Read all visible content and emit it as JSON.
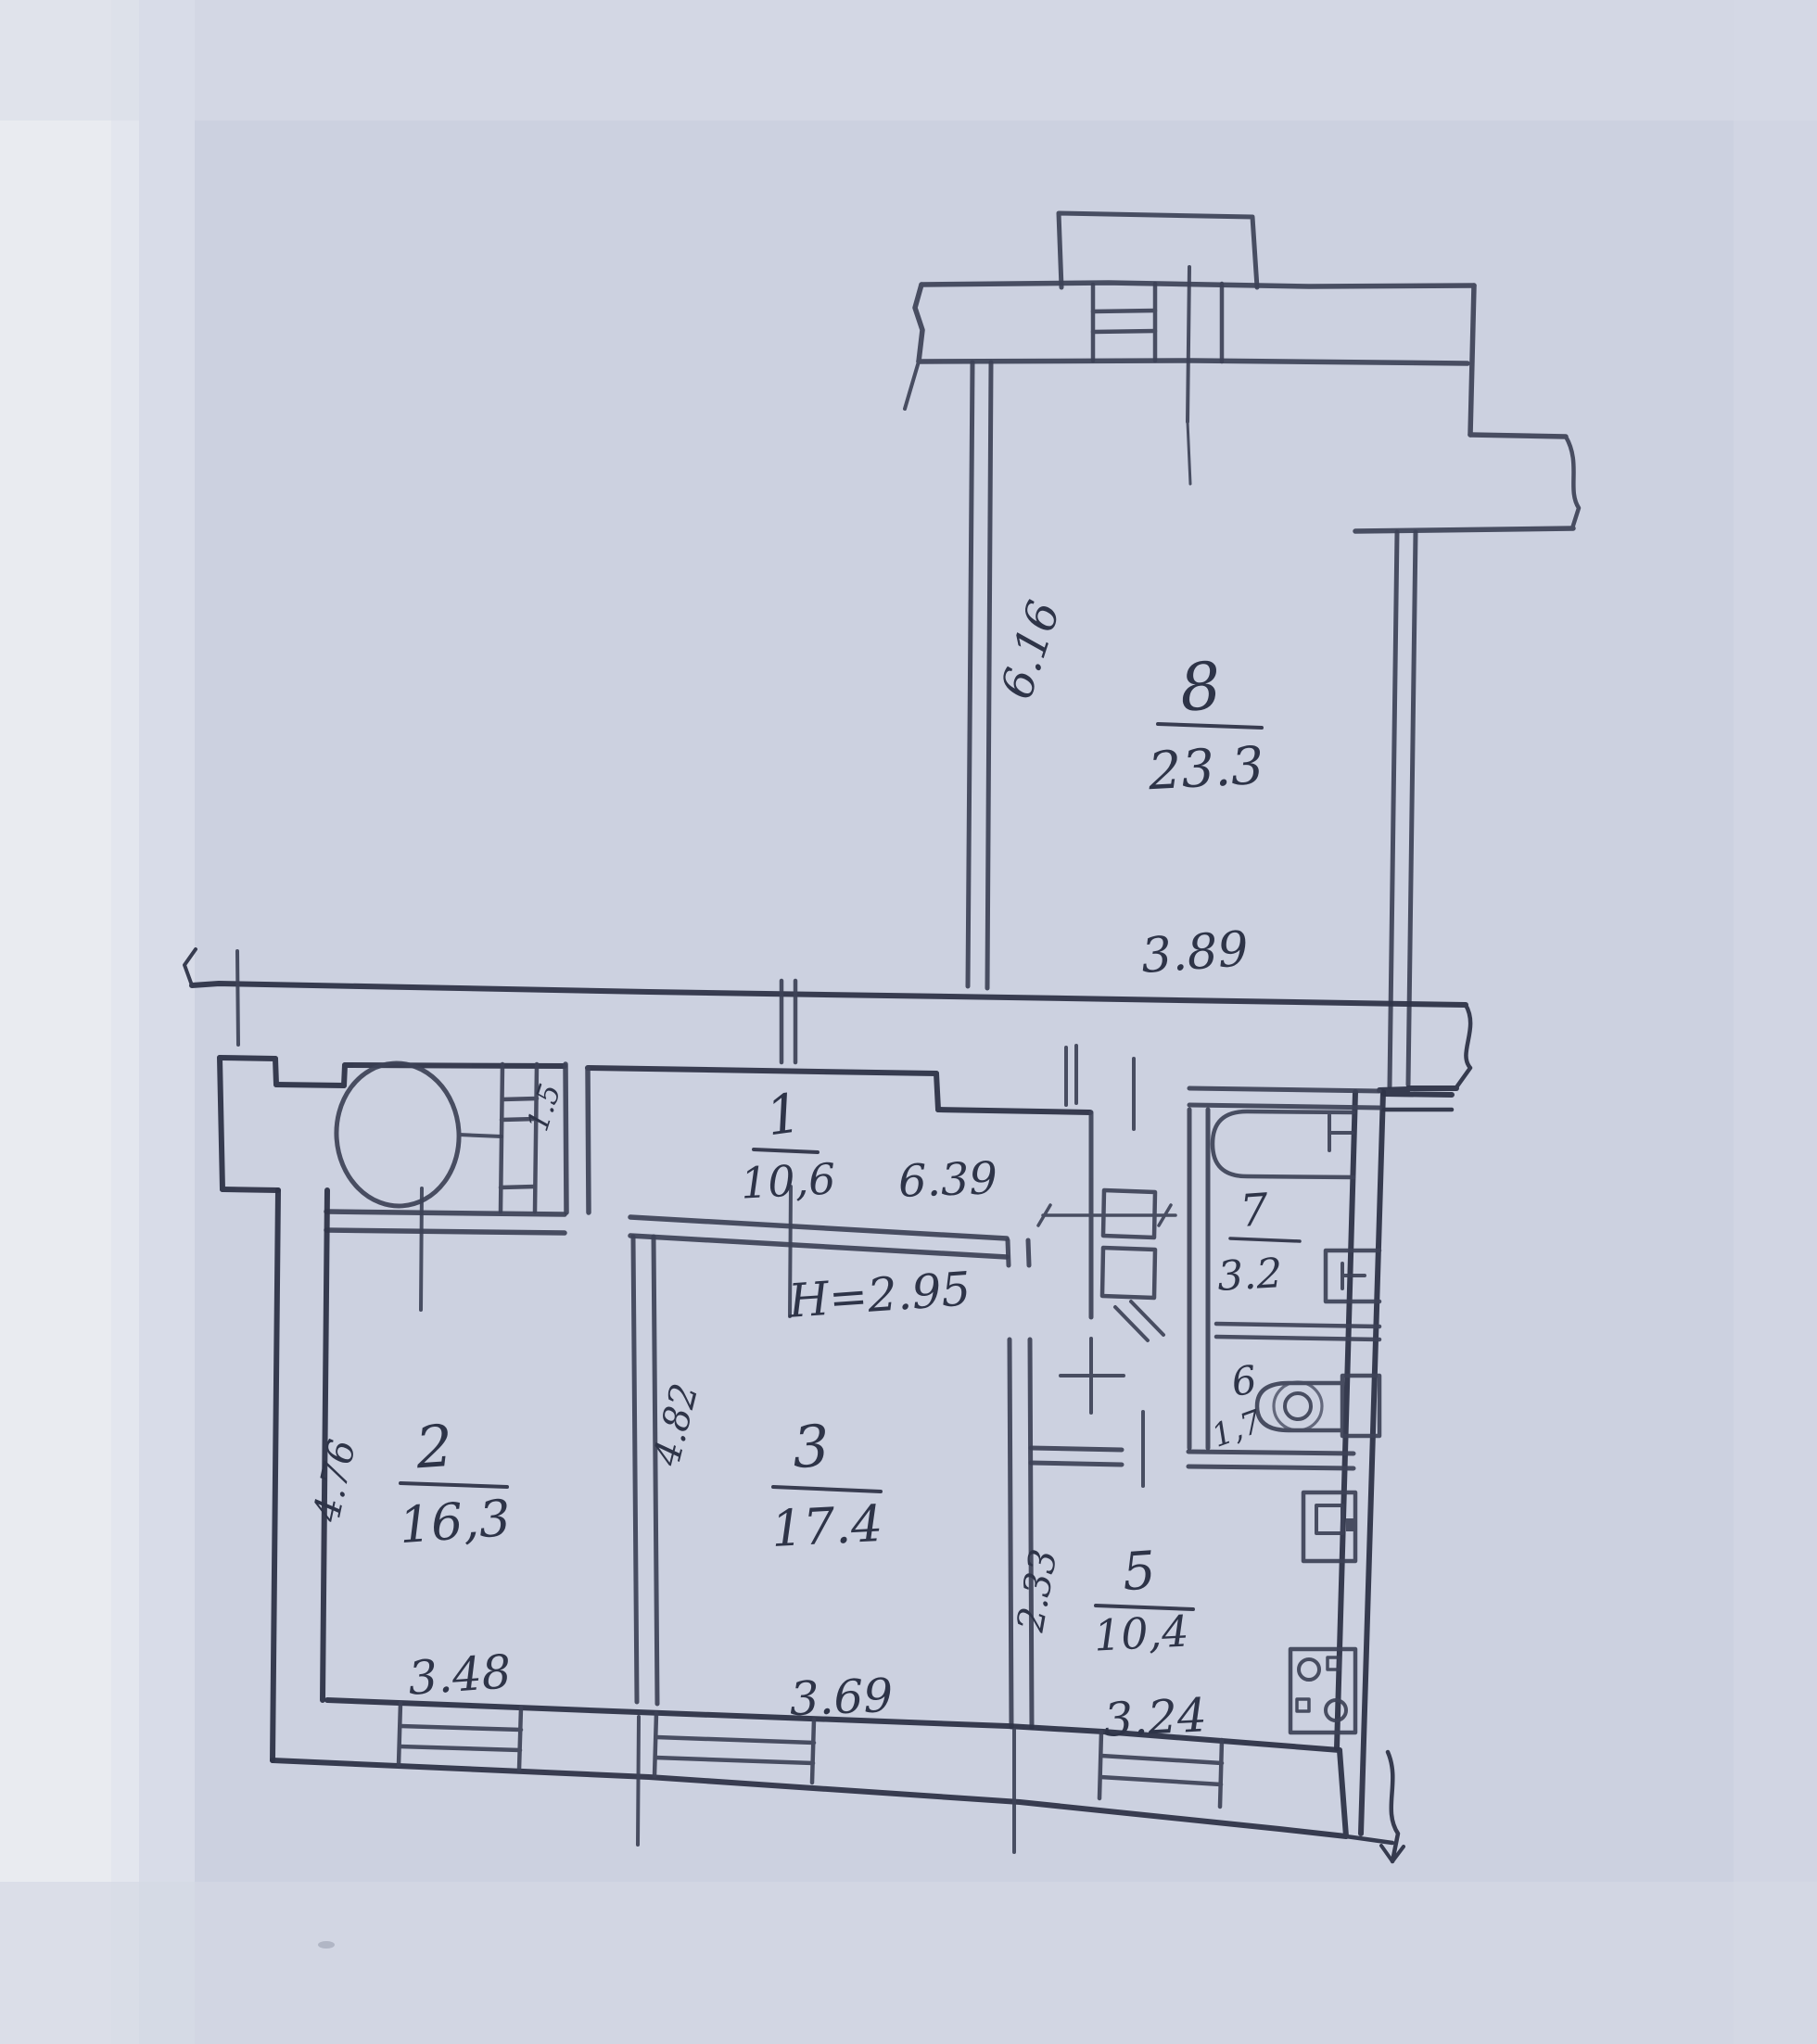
{
  "plan": {
    "type": "hand-drawn apartment floor plan",
    "rooms": {
      "r8": {
        "number": "8",
        "area": "23.3",
        "side": "6.16",
        "top": "3.89"
      },
      "r1": {
        "number": "1",
        "area": "10,6",
        "length": "6.39",
        "height": "H=2.95"
      },
      "r2": {
        "number": "2",
        "area": "16,3",
        "side": "4.76",
        "bottom": "3.48"
      },
      "r3": {
        "number": "3",
        "area": "17.4",
        "side": "4.82",
        "bottom": "3.69"
      },
      "r5": {
        "number": "5",
        "area": "10,4",
        "side": "2.33",
        "bottom": "3.24"
      },
      "r6": {
        "number": "6",
        "area": "1,7"
      },
      "r7": {
        "number": "7",
        "area": "3.2"
      }
    },
    "vent_label": "1.5"
  }
}
